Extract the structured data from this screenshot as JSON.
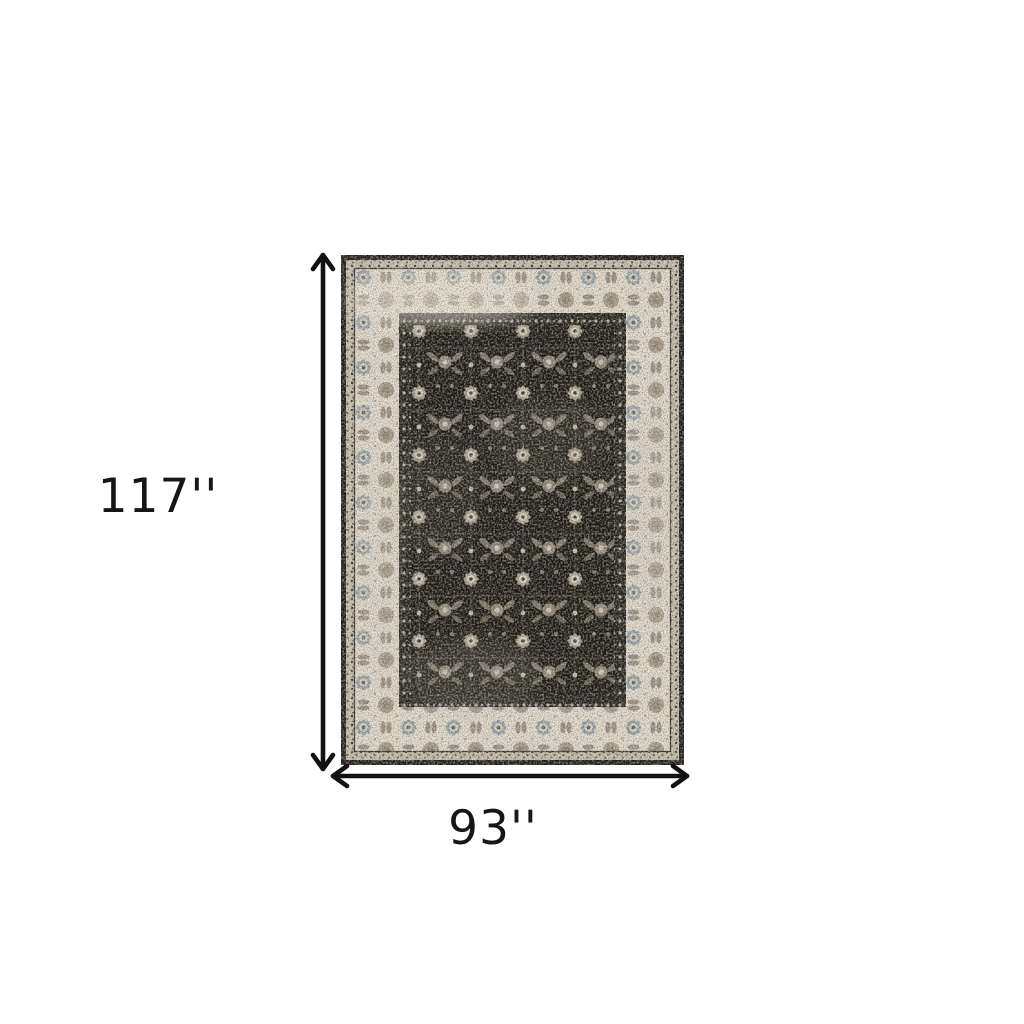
{
  "page": {
    "background": "#ffffff"
  },
  "dimensions": {
    "height_label": "117''",
    "width_label": "93''"
  },
  "icons": {
    "vertical_arrow": "double-ended-vertical-dimension-arrow-icon",
    "horizontal_arrow": "double-ended-horizontal-dimension-arrow-icon"
  },
  "colors": {
    "arrow": "#121212",
    "label_text": "#161616",
    "rug_outer_edge": "#1c1a16",
    "rug_guard_light": "#c6bfb0",
    "rug_border_cream": "#e3dccd",
    "rug_border_motif_taupe": "#a39884",
    "rug_border_motif_blue": "#93a2a9",
    "rug_inner_guard_dark": "#211f19",
    "rug_field_black": "#17150f",
    "rug_field_motif_light": "#aba190",
    "rug_field_motif_cream": "#d9d3c5"
  }
}
